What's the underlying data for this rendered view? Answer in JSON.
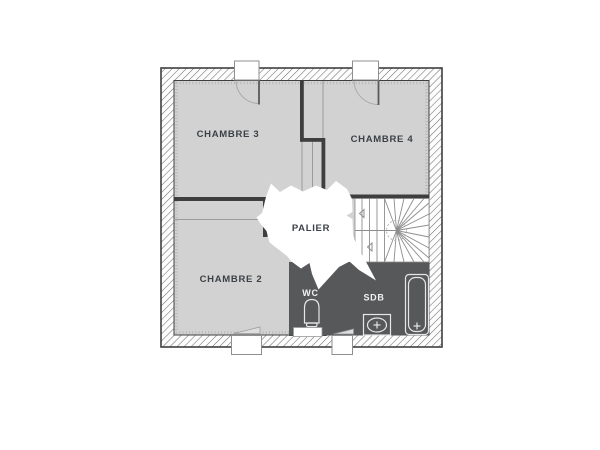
{
  "plan": {
    "title": "floor-plan-etage",
    "rooms": [
      {
        "id": "chambre3",
        "label": "CHAMBRE 3",
        "fill": "light"
      },
      {
        "id": "chambre4",
        "label": "CHAMBRE 4",
        "fill": "light"
      },
      {
        "id": "chambre2",
        "label": "CHAMBRE 2",
        "fill": "light"
      },
      {
        "id": "palier",
        "label": "PALIER",
        "fill": "white"
      },
      {
        "id": "wc",
        "label": "WC",
        "fill": "dark"
      },
      {
        "id": "sdb",
        "label": "SDB",
        "fill": "dark"
      }
    ],
    "fixtures": [
      "staircase",
      "toilet-icon",
      "sink-icon",
      "bathtub-icon"
    ],
    "openings": {
      "windows_top": 2,
      "windows_bottom": 3,
      "door_arcs": 2
    },
    "colors": {
      "floor_light": "#d2d2d2",
      "floor_dark": "#57585a",
      "wall": "#3e3e3e",
      "open_area": "#ffffff",
      "hatch_line": "#6e6e6e",
      "insulation_dots": "#b8b8b8",
      "stair_line": "#8d8d8d",
      "label_dark": "#3b4147",
      "label_light": "#f2f2f2",
      "window_border": "#8f8f8f"
    }
  }
}
